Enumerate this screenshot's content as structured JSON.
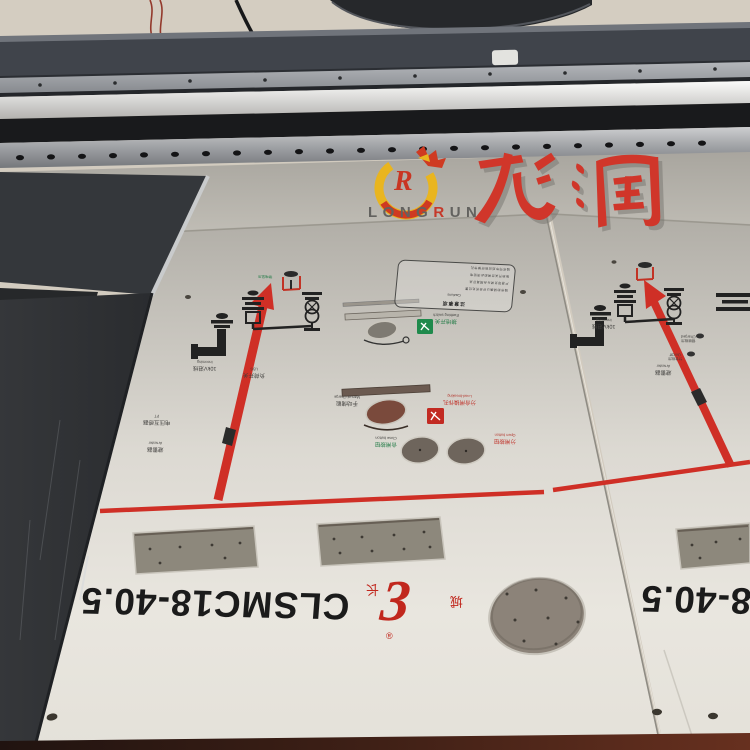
{
  "watermark": {
    "latin_pre": "LONG",
    "latin_r": "R",
    "latin_post": "UN",
    "cn": "龙润",
    "r_mark": "R"
  },
  "panels": {
    "model": "CLSMC18-40.5",
    "brand": {
      "glyph": "3",
      "char_a": "长",
      "char_b": "城",
      "reg": "®"
    },
    "caution": {
      "title": "注意事项",
      "subtitle": "Cautions",
      "lines": [
        "操作前请确认开关所处位置",
        "严禁带负荷分合隔离开关",
        "接地开关合闸前必须验电",
        "操作完毕后应锁好操作孔"
      ]
    },
    "labels": {
      "vd_cn": "带电显示",
      "incoming_cn": "10kV进线",
      "incoming_en": "Incoming",
      "pt_cn": "电压互感器",
      "pt_en": "PT",
      "arrester_cn": "避雷器",
      "arrester_en": "Arrester",
      "lbs_cn": "负荷开关",
      "lbs_en": "LBS",
      "earthing_cn": "接地开关",
      "earthing_en": "Earthing switch",
      "manual_cn": "手动储能",
      "manual_en": "Manual Charge",
      "loadbreak_cn": "分合闸操作孔",
      "loadbreak_en": "Load-breaking",
      "close_cn": "合闸按钮",
      "close_en": "Close button",
      "open_cn": "分闸按钮",
      "open_en": "Open button",
      "charged_cn": "储能指示",
      "charged_en": "Charged",
      "onoff_cn": "分合指示",
      "onoff_en": "On/Off"
    }
  },
  "colors": {
    "print_red": "#cf2f26",
    "label_green": "#1f7a44",
    "label_red": "#c03028",
    "brand_red": "#c1271d",
    "watermark_red": "#d0362a",
    "watermark_yellow": "#e9b51f"
  }
}
